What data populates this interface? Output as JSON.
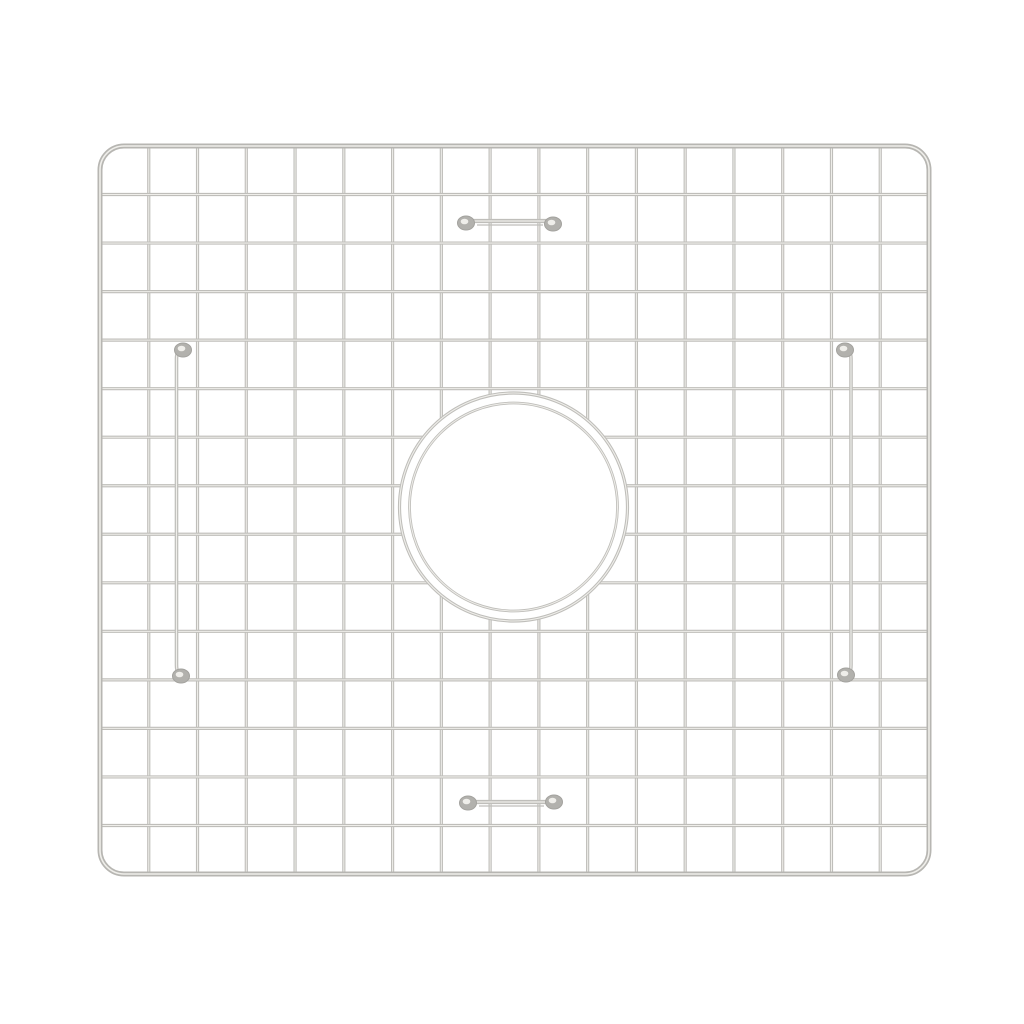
{
  "scene": {
    "description": "Product photo of a stainless steel kitchen sink bottom grid with a round center drain opening, shown on a plain white background",
    "background_color": "#ffffff"
  },
  "figure": {
    "type": "sink-grid",
    "canvas": {
      "width": 1024,
      "height": 1024
    },
    "colors": {
      "wire": "#bfbeba",
      "wire_highlight": "#efeeea",
      "frame": "#b7b6b2",
      "pad": "#b2b1ad",
      "pad_edge": "#a3a29e",
      "background": "#ffffff"
    },
    "frame": {
      "x": 100,
      "y": 146,
      "width": 829,
      "height": 728,
      "corner_radius": 24,
      "stroke_width": 5
    },
    "grid": {
      "columns": 17,
      "rows": 15,
      "wire_stroke_width": 3.2
    },
    "drain_opening": {
      "cx": 513.5,
      "cy": 507,
      "outer_radius": 114,
      "inner_radius": 104,
      "ring_stroke_width": 3.2
    },
    "feet": {
      "pad_rx": 8.5,
      "pad_ry": 7,
      "side_rails": [
        {
          "side": "left",
          "x": 176.5,
          "y1": 352,
          "y2": 672,
          "bend": 7,
          "pads": [
            [
              183,
              350
            ],
            [
              181,
              676
            ]
          ]
        },
        {
          "side": "right",
          "x": 851,
          "y1": 352,
          "y2": 672,
          "bend": -7,
          "pads": [
            [
              845,
              350
            ],
            [
              846,
              675
            ]
          ]
        }
      ],
      "cross_bars": [
        {
          "side": "top",
          "y": 221,
          "x1": 471,
          "x2": 549,
          "pads": [
            [
              466,
              223
            ],
            [
              553,
              224
            ]
          ]
        },
        {
          "side": "bottom",
          "y": 802,
          "x1": 473,
          "x2": 550,
          "pads": [
            [
              468,
              803
            ],
            [
              554,
              802
            ]
          ]
        }
      ]
    }
  }
}
